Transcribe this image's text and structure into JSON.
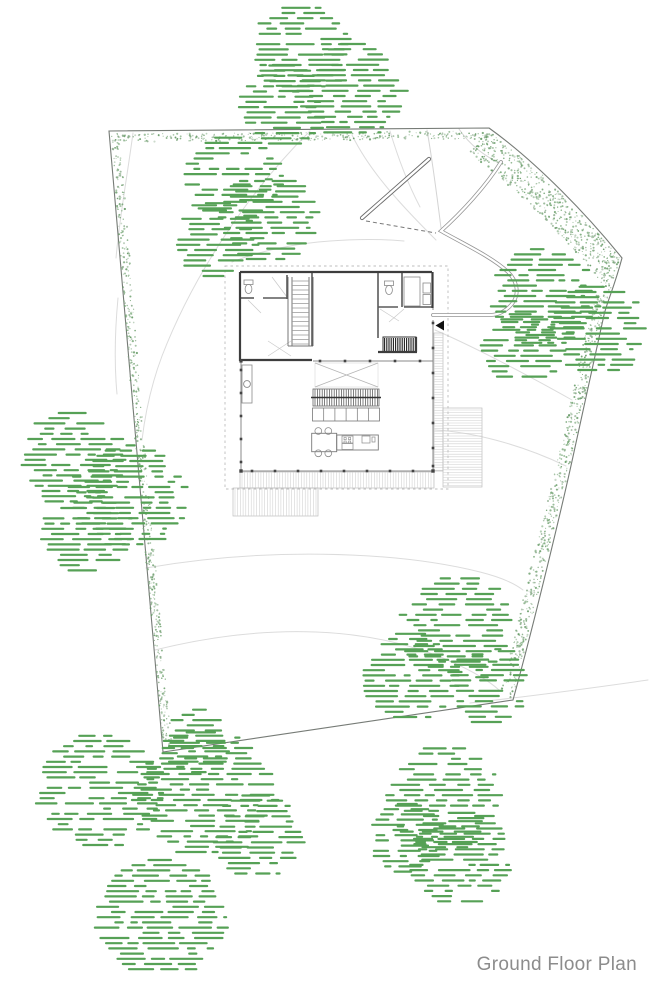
{
  "caption": "Ground Floor Plan",
  "colors": {
    "background": "#ffffff",
    "tree_green": "#56a156",
    "stipple_green": "#79a879",
    "stipple_alt1": "#8fae8f",
    "stipple_alt2": "#649a64",
    "boundary": "#767b76",
    "wall_dark": "#3d3d3d",
    "wall_mid": "#8a8a8a",
    "line_light": "#c9c9c9",
    "contour": "#dcdcdc",
    "drive": "#949494",
    "drive_wall": "#6a6a6a",
    "deck_line": "#cfcfcf",
    "deck_edge": "#bdbdbd",
    "hatch_dark": "#1e1e1e",
    "label_gray": "#8c8c8c",
    "arrow_black": "#111111"
  },
  "trees": {
    "crowns": [
      [
        300,
        52,
        48
      ],
      [
        352,
        90,
        50
      ],
      [
        283,
        106,
        44
      ],
      [
        233,
        180,
        46
      ],
      [
        267,
        220,
        48
      ],
      [
        217,
        240,
        40
      ],
      [
        543,
        297,
        52
      ],
      [
        596,
        331,
        48
      ],
      [
        521,
        351,
        40
      ],
      [
        73,
        459,
        50
      ],
      [
        128,
        496,
        55
      ],
      [
        86,
        532,
        43
      ],
      [
        459,
        629,
        55
      ],
      [
        409,
        677,
        47
      ],
      [
        487,
        686,
        40
      ],
      [
        100,
        791,
        60
      ],
      [
        204,
        794,
        67
      ],
      [
        160,
        917,
        62
      ],
      [
        256,
        836,
        44
      ],
      [
        196,
        741,
        34
      ],
      [
        444,
        799,
        55
      ],
      [
        459,
        858,
        49
      ],
      [
        405,
        838,
        37
      ]
    ]
  }
}
